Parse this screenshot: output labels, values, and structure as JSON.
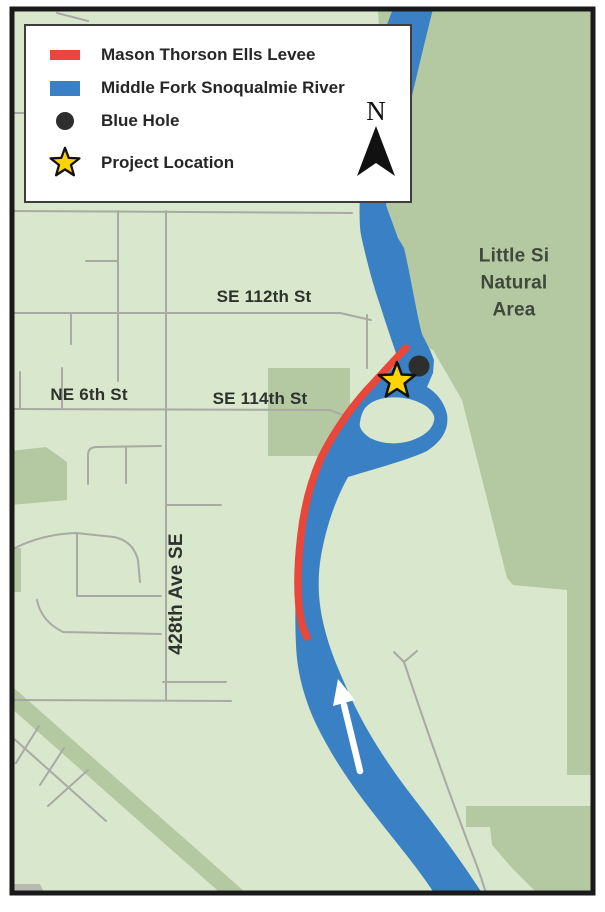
{
  "legend": {
    "items": [
      {
        "label": "Mason Thorson Ells Levee"
      },
      {
        "label": "Middle Fork Snoqualmie River"
      },
      {
        "label": "Blue Hole"
      },
      {
        "label": "Project Location"
      }
    ]
  },
  "north_arrow": {
    "label": "N"
  },
  "labels": {
    "street_se_112th": "SE 112th St",
    "street_ne_6th": "NE 6th St",
    "street_se_114th": "SE 114th St",
    "street_428th_ave": "428th Ave SE",
    "natural_area_line1": "Little Si",
    "natural_area_line2": "Natural",
    "natural_area_line3": "Area"
  },
  "colors": {
    "map_base_green": "#d9e7cc",
    "natural_area_green": "#b4c9a2",
    "river_blue": "#3a80c4",
    "levee_red": "#e8473a",
    "road_gray": "#a8aaa3",
    "star_yellow": "#ffd400",
    "blue_hole_dot": "#2e2e2e",
    "border_black": "#1a1a1a",
    "flow_arrow_white": "#ffffff",
    "gravel_gray": "#b7bbb1"
  }
}
